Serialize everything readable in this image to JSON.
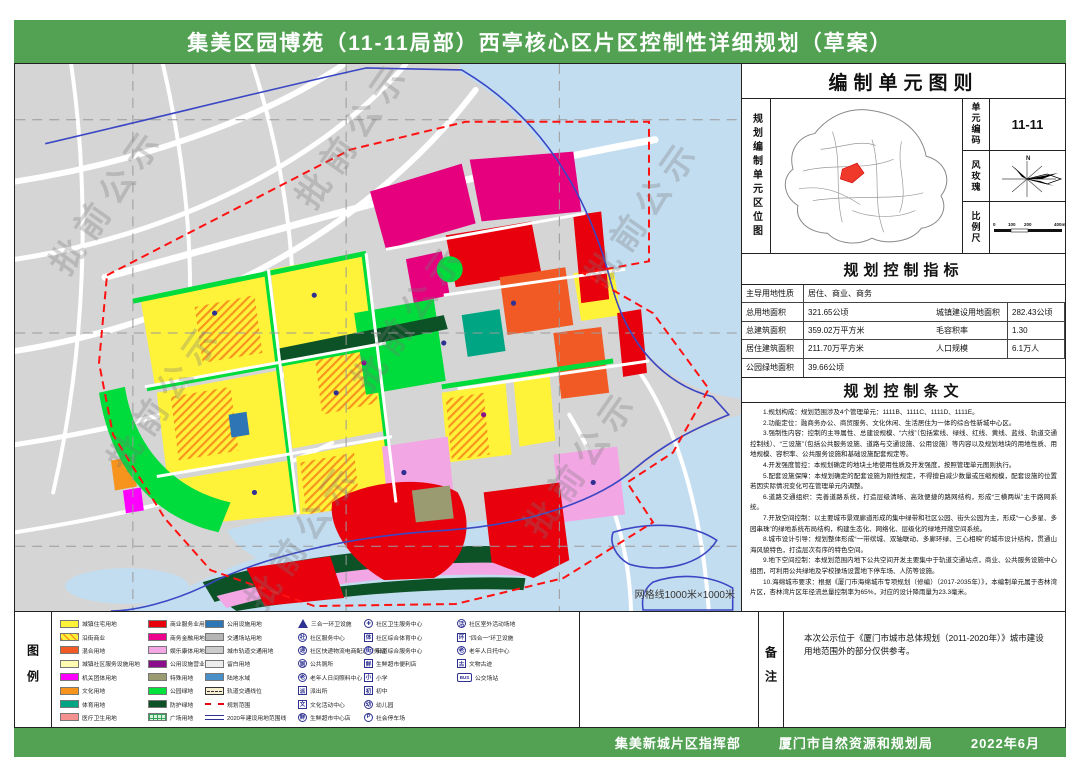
{
  "header": {
    "title": "集美区园博苑（11-11局部）西亭核心区片区控制性详细规划（草案）"
  },
  "footer": {
    "org1": "集美新城片区指挥部",
    "org2": "厦门市自然资源和规划局",
    "date": "2022年6月"
  },
  "map": {
    "grid_label": "网格线1000米×1000米",
    "watermark": "批前公示"
  },
  "right_panel": {
    "sheet_title": "编制单元图则",
    "location": {
      "side_label": "规划编制单元区位图",
      "unit_code_label": "单元编码",
      "unit_code_value": "11-11",
      "wind_rose_label": "风玫瑰",
      "wind_rose_north": "N",
      "scale_label": "比例尺",
      "scale_ticks": [
        "0",
        "100",
        "200",
        "400m"
      ]
    },
    "indicators": {
      "title": "规划控制指标",
      "rows": [
        {
          "label": "主导用地性质",
          "value": "居住、商业、商务",
          "span": true
        },
        {
          "label": "总用地面积",
          "value": "321.65公顷",
          "label2": "城镇建设用地面积",
          "value2": "282.43公顷"
        },
        {
          "label": "总建筑面积",
          "value": "359.02万平方米",
          "label2": "毛容积率",
          "value2": "1.30"
        },
        {
          "label": "居住建筑面积",
          "value": "211.70万平方米",
          "label2": "人口规模",
          "value2": "6.1万人"
        },
        {
          "label": "公园绿地面积",
          "value": "39.66公顷",
          "span": true
        }
      ]
    },
    "provisions": {
      "title": "规划控制条文",
      "items": [
        "1.规划构成：规划范围涉及4个管理单元：1111B、1111C、1111D、1111E。",
        "2.功能定位：融商务办公、商贸服务、文化休闲、生活居住为一体的综合性新城中心区。",
        "3.强制性内容：控制的主导属性、总建设规模、“六线”（包括紫线、绿线、红线、黄线、蓝线、轨道交通控制线）、“三设施”（包括公共服务设施、道路与交通设施、公用设施）等内容以及规划地块的用地性质、用地规模、容积率、公共服务设施和基础设施配套规定等。",
        "4.开发强度管控：本规划确定的地块土地使用性质及开发强度，按照管理单元图则执行。",
        "5.配套设施保障：本规划确定的配套设施为刚性规定，不得擅自减少数量或压缩规模，配套设施的位置若因实际情况变化可在管理单元内调整。",
        "6.道路交通组织：完善道路系统，打造层级清晰、高效便捷的路网结构，形成“三横两纵”主干路网系统。",
        "7.开放空间控制：以主要城市景观廊道形成的集中绿带和社区公园、街头公园为主，形成“一心多星、多园串珠”的绿地系统布局结构，构建生态化、网络化、层级化的绿地开敞空间系统。",
        "8.城市设计引导：规划整体形成“一带缤城、双轴联动、多廊环绿、三心相映”的城市设计结构，贯通山海风貌特色，打造层次有序的特色空间。",
        "9.地下空间控制：本规划范围内地下公共空间开发主要集中于轨道交通站点，商业、公共服务设施中心组团，可利用公共绿地及学校操场设置地下停车场、人防等设施。",
        "10.海绵城市要求：根据《厦门市海绵城市专项规划（修编）（2017-2035年）》，本编制单元属于杏林湾片区，杏林湾片区年径流总量控制率为65%，对应的设计降雨量为23.3毫米。"
      ]
    }
  },
  "legend": {
    "side_label": "图例",
    "columns": [
      {
        "items": [
          {
            "label": "城镇住宅用地",
            "type": "color",
            "color": "#FFF33A"
          },
          {
            "label": "沿街商业",
            "type": "hatch",
            "color": "#FFF33A",
            "hatch": "#F7941D"
          },
          {
            "label": "混合用地",
            "type": "color",
            "color": "#F15A24"
          },
          {
            "label": "城镇社区服务设施用地",
            "type": "color",
            "color": "#FFFBB0"
          },
          {
            "label": "机关团体用地",
            "type": "color",
            "color": "#FF00FF"
          },
          {
            "label": "文化用地",
            "type": "color",
            "color": "#F7941D"
          },
          {
            "label": "体育用地",
            "type": "color",
            "color": "#00A583"
          },
          {
            "label": "医疗卫生用地",
            "type": "color",
            "color": "#F2918F"
          }
        ]
      },
      {
        "items": [
          {
            "label": "商业服务业用地",
            "type": "color",
            "color": "#E8000D"
          },
          {
            "label": "商务金融用地",
            "type": "color",
            "color": "#EC008C"
          },
          {
            "label": "娱乐康体用地",
            "type": "color",
            "color": "#F2A6E4"
          },
          {
            "label": "公用设施营业网点",
            "type": "color",
            "color": "#8B0E8B"
          },
          {
            "label": "特殊用地",
            "type": "color",
            "color": "#9A9B70"
          },
          {
            "label": "公园绿地",
            "type": "color",
            "color": "#00E13C"
          },
          {
            "label": "防护绿地",
            "type": "color",
            "color": "#0C5226"
          },
          {
            "label": "广场用地",
            "type": "grid",
            "color": "#D9F2DD",
            "grid": "#35A25A"
          }
        ]
      },
      {
        "items": [
          {
            "label": "公用设施用地",
            "type": "color",
            "color": "#2E75B6"
          },
          {
            "label": "交通场站用地",
            "type": "color",
            "color": "#B5B5B5"
          },
          {
            "label": "城市轨道交通用地",
            "type": "color",
            "color": "#CCCCCC"
          },
          {
            "label": "留白用地",
            "type": "color",
            "color": "#EDEDED"
          },
          {
            "label": "陆地水域",
            "type": "color",
            "color": "#4A90C8"
          },
          {
            "label": "轨道交通线位",
            "type": "track",
            "color": "#F6EFD2"
          },
          {
            "label": "规划范围",
            "type": "dash-red",
            "color": "#E60012"
          },
          {
            "label": "2020年建设用地范围线",
            "type": "double-blue",
            "color": "#2E3192"
          }
        ]
      },
      {
        "items": [
          {
            "label": "三合一环卫设施",
            "shape": "triangle",
            "glyph": ""
          },
          {
            "label": "社区服务中心",
            "shape": "circle",
            "glyph": "社"
          },
          {
            "label": "社区快递物流电商配送服务站",
            "shape": "circle",
            "glyph": "递"
          },
          {
            "label": "公共厕所",
            "shape": "circle",
            "glyph": "厕"
          },
          {
            "label": "老年人日间照料中心",
            "shape": "circle",
            "glyph": "老"
          },
          {
            "label": "派出所",
            "shape": "square",
            "glyph": "派"
          },
          {
            "label": "文化活动中心",
            "shape": "square",
            "glyph": "文"
          },
          {
            "label": "生鲜超市中心店",
            "shape": "circle",
            "glyph": "鲜"
          }
        ]
      },
      {
        "items": [
          {
            "label": "社区卫生服务中心",
            "shape": "circle",
            "glyph": "✚"
          },
          {
            "label": "社区综合体育中心",
            "shape": "square",
            "glyph": "体"
          },
          {
            "label": "街道综合服务中心",
            "shape": "circle",
            "glyph": "街"
          },
          {
            "label": "生鲜超市便利店",
            "shape": "square",
            "glyph": "鲜"
          },
          {
            "label": "小学",
            "shape": "square",
            "glyph": "小"
          },
          {
            "label": "初中",
            "shape": "square",
            "glyph": "初"
          },
          {
            "label": "幼儿园",
            "shape": "circle",
            "glyph": "幼"
          },
          {
            "label": "社会停车场",
            "shape": "circle",
            "glyph": "P"
          }
        ]
      },
      {
        "items": [
          {
            "label": "社区室外活动场地",
            "shape": "circle",
            "glyph": "活"
          },
          {
            "label": "“四合一”环卫设施",
            "shape": "square",
            "glyph": "环"
          },
          {
            "label": "老年人日托中心",
            "shape": "circle",
            "glyph": "老"
          },
          {
            "label": "文物古迹",
            "shape": "square",
            "glyph": "古"
          },
          {
            "label": "公交场站",
            "shape": "bus",
            "glyph": "BUS"
          }
        ]
      }
    ]
  },
  "notes": {
    "side_label": "备注",
    "text": "本次公示位于《厦门市城市总体规划（2011-2020年）》城市建设用地范围外的部分仅供参考。"
  }
}
